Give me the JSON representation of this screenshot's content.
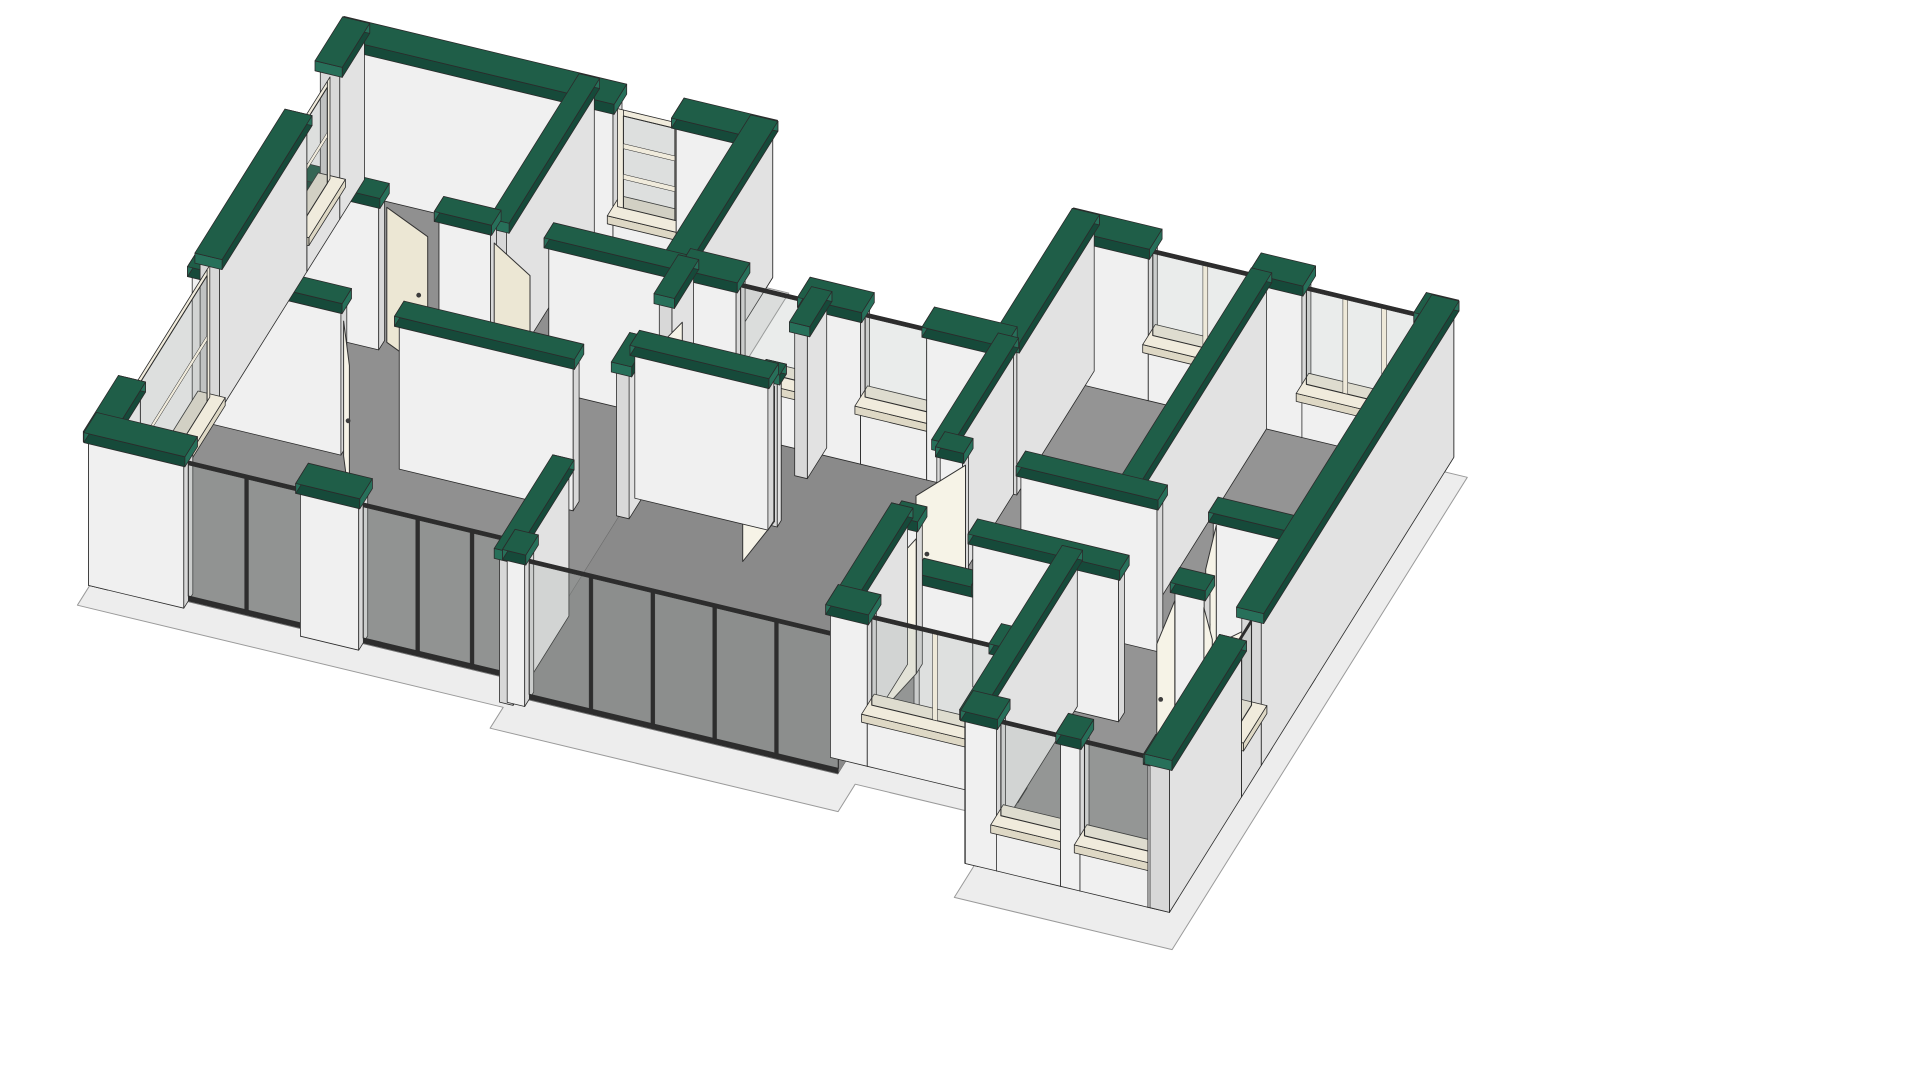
{
  "meta": {
    "view_label": "3D cutaway axonometric floor plan",
    "background": "#ffffff"
  },
  "colors": {
    "line": "#2b2b2b",
    "capTop": "#1f5e48",
    "capSkirt": "#164a3a",
    "capEnd": "#27705a",
    "wallFaceU": "#f0f0f0",
    "wallFaceV": "#e2e2e2",
    "wallEnd": "#d8d8d8",
    "floor1": "#909090",
    "floor2": "#8a8a8a",
    "floor3": "#949494",
    "floorStroke": "#6f6f6f",
    "slab": "#ededed",
    "slabStroke": "#9a9a9a",
    "door": "#f6f3e7",
    "doorShade": "#ece7d4",
    "handle": "#3c3c3c",
    "sill": "#f0ebdc",
    "sillShade": "#ded8c5",
    "glass": "rgba(150,158,155,0.20)",
    "glassDark": "rgba(120,128,125,0.25)",
    "frameDark": "#2d2d2d",
    "postCream": "#eee9d9",
    "halfTop": "#e9e9e9"
  },
  "scene": {
    "projection": {
      "origin": [
        345,
        175
      ],
      "u": [
        0.972,
        0.233
      ],
      "v": [
        -0.45,
        0.72
      ],
      "wallHeight": 148,
      "doorHeight": 135,
      "slabDrop": 20
    },
    "slab": {
      "name": "foundation-slab",
      "pts": [
        [
          -10,
          -10
        ],
        [
          452,
          -10
        ],
        [
          452,
          178
        ],
        [
          758,
          178
        ],
        [
          758,
          16
        ],
        [
          1162,
          16
        ],
        [
          1162,
          672
        ],
        [
          938,
          672
        ],
        [
          938,
          564
        ],
        [
          786,
          564
        ],
        [
          786,
          602
        ],
        [
          428,
          602
        ],
        [
          428,
          573
        ],
        [
          -10,
          573
        ]
      ]
    },
    "floors": [
      {
        "id": "left-wing-floor",
        "color": "floor1",
        "pts": [
          [
            14,
            14
          ],
          [
            436,
            14
          ],
          [
            436,
            561
          ],
          [
            14,
            561
          ]
        ]
      },
      {
        "id": "central-floor",
        "color": "floor2",
        "pts": [
          [
            436,
            196
          ],
          [
            776,
            196
          ],
          [
            776,
            581
          ],
          [
            436,
            581
          ]
        ]
      },
      {
        "id": "right-wing-floor",
        "color": "floor3",
        "pts": [
          [
            762,
            36
          ],
          [
            1146,
            36
          ],
          [
            1146,
            651
          ],
          [
            953,
            651
          ],
          [
            953,
            551
          ],
          [
            762,
            551
          ]
        ]
      }
    ],
    "walls": [
      {
        "id": "lw-n",
        "dir": "u",
        "c": 10,
        "t": 20,
        "from": 0,
        "to": 440,
        "cap": true,
        "open": [
          {
            "a": 285,
            "b": 350,
            "k": "winf",
            "sill": 34,
            "head": 140,
            "bars": 2
          }
        ]
      },
      {
        "id": "lw-w",
        "dir": "v",
        "c": 10,
        "t": 20,
        "from": 0,
        "to": 570,
        "cap": true,
        "open": [
          {
            "a": 55,
            "b": 128,
            "k": "winf",
            "sill": 30,
            "head": 140,
            "bars": 1
          },
          {
            "a": 322,
            "b": 498,
            "k": "winf",
            "sill": 4,
            "head": 144,
            "bars": 1
          }
        ]
      },
      {
        "id": "lw-s",
        "dir": "u",
        "c": 560,
        "t": 20,
        "from": 0,
        "to": 446,
        "cap": true,
        "open": [
          {
            "a": 98,
            "b": 218,
            "k": "glass"
          },
          {
            "a": 278,
            "b": 446,
            "k": "glass"
          }
        ]
      },
      {
        "id": "lw-e",
        "dir": "v",
        "c": 430,
        "t": 20,
        "from": 0,
        "to": 190,
        "cap": true,
        "open": []
      },
      {
        "id": "lw-i1",
        "dir": "u",
        "c": 195,
        "t": 13,
        "from": 0,
        "to": 440,
        "cap": true,
        "open": [
          {
            "a": 128,
            "b": 190,
            "k": "door"
          },
          {
            "a": 243,
            "b": 303,
            "k": "door"
          }
        ]
      },
      {
        "id": "lw-i2",
        "dir": "v",
        "c": 250,
        "t": 13,
        "from": 0,
        "to": 195,
        "cap": true,
        "open": []
      },
      {
        "id": "lw-i3",
        "dir": "u",
        "c": 333,
        "t": 13,
        "from": 0,
        "to": 392,
        "cap": true,
        "open": [
          {
            "a": 153,
            "b": 213,
            "k": "door"
          }
        ]
      },
      {
        "id": "lw-i4",
        "dir": "v",
        "c": 440,
        "t": 13,
        "from": 190,
        "to": 333,
        "cap": true,
        "open": [
          {
            "a": 238,
            "b": 298,
            "k": "door"
          }
        ]
      },
      {
        "id": "c-n",
        "dir": "u",
        "c": 190,
        "t": 20,
        "from": 440,
        "to": 770,
        "cap": true,
        "open": [
          {
            "a": 495,
            "b": 563,
            "k": "win",
            "sill": 52
          },
          {
            "a": 623,
            "b": 691,
            "k": "win",
            "sill": 52
          }
        ]
      },
      {
        "id": "c-room-s",
        "dir": "u",
        "c": 300,
        "t": 13,
        "from": 440,
        "to": 577,
        "cap": true,
        "open": []
      },
      {
        "id": "c-room-e",
        "dir": "v",
        "c": 577,
        "t": 13,
        "from": 190,
        "to": 300,
        "cap": true,
        "open": [
          {
            "a": 233,
            "b": 291,
            "k": "door"
          }
        ]
      },
      {
        "id": "c-s",
        "dir": "u",
        "c": 580,
        "t": 20,
        "from": 440,
        "to": 776,
        "cap": true,
        "open": [
          {
            "a": 458,
            "b": 776,
            "k": "glass"
          }
        ]
      },
      {
        "id": "c-w-stub",
        "dir": "v",
        "c": 440,
        "t": 14,
        "from": 468,
        "to": 592,
        "cap": true,
        "open": []
      },
      {
        "id": "rw-w-up",
        "dir": "v",
        "c": 770,
        "t": 20,
        "from": 20,
        "to": 192,
        "cap": true,
        "open": []
      },
      {
        "id": "rw-w-mid",
        "dir": "v",
        "c": 770,
        "t": 13,
        "from": 192,
        "to": 334,
        "cap": true,
        "open": []
      },
      {
        "id": "rw-w-low",
        "dir": "v",
        "c": 770,
        "t": 14,
        "from": 428,
        "to": 560,
        "cap": true,
        "open": []
      },
      {
        "id": "rw-n",
        "dir": "u",
        "c": 30,
        "t": 20,
        "from": 760,
        "to": 1150,
        "cap": true,
        "open": [
          {
            "a": 845,
            "b": 953,
            "k": "win",
            "sill": 50,
            "posts": 1
          },
          {
            "a": 1003,
            "b": 1123,
            "k": "win",
            "sill": 38,
            "posts": 2
          }
        ]
      },
      {
        "id": "rw-div",
        "dir": "v",
        "c": 960,
        "t": 13,
        "from": 40,
        "to": 334,
        "cap": true,
        "open": []
      },
      {
        "id": "rw-hall-n",
        "dir": "u",
        "c": 334,
        "t": 13,
        "from": 770,
        "to": 1150,
        "cap": true,
        "open": [
          {
            "a": 793,
            "b": 853,
            "k": "door"
          },
          {
            "a": 993,
            "b": 1051,
            "k": "door"
          }
        ]
      },
      {
        "id": "rw-hall-s",
        "dir": "u",
        "c": 430,
        "t": 13,
        "from": 770,
        "to": 1150,
        "cap": true,
        "open": [
          {
            "a": 790,
            "b": 848,
            "k": "door"
          },
          {
            "a": 998,
            "b": 1056,
            "k": "door"
          },
          {
            "a": 1086,
            "b": 1146,
            "k": "door"
          }
        ]
      },
      {
        "id": "rw-bath-s",
        "dir": "u",
        "c": 553,
        "t": 20,
        "from": 760,
        "to": 953,
        "cap": true,
        "open": [
          {
            "a": 798,
            "b": 928,
            "k": "win",
            "sill": 46,
            "posts": 1
          }
        ]
      },
      {
        "id": "rw-master-w",
        "dir": "v",
        "c": 946,
        "t": 13,
        "from": 430,
        "to": 652,
        "cap": true,
        "open": []
      },
      {
        "id": "rw-master-s",
        "dir": "u",
        "c": 642,
        "t": 20,
        "from": 940,
        "to": 1150,
        "cap": true,
        "open": [
          {
            "a": 972,
            "b": 1038,
            "k": "win",
            "sill": 40
          },
          {
            "a": 1058,
            "b": 1128,
            "k": "win",
            "sill": 40
          }
        ]
      },
      {
        "id": "rw-e",
        "dir": "v",
        "c": 1140,
        "t": 20,
        "from": 20,
        "to": 652,
        "cap": true,
        "open": [
          {
            "a": 448,
            "b": 492,
            "k": "win",
            "sill": 50
          }
        ]
      },
      {
        "id": "bath-wc-e",
        "dir": "v",
        "c": 887,
        "t": 13,
        "from": 430,
        "to": 498,
        "cap": true,
        "open": []
      },
      {
        "id": "bath-wc-s",
        "dir": "u",
        "c": 493,
        "t": 13,
        "from": 822,
        "to": 887,
        "cap": true,
        "open": []
      },
      {
        "id": "bath-half",
        "dir": "v",
        "c": 820,
        "t": 10,
        "from": 430,
        "to": 496,
        "cap": false,
        "h": 78,
        "open": []
      }
    ],
    "doors": [
      {
        "id": "door-bed1",
        "afterWall": "lw-i1",
        "hinge": [
          131,
          190
        ],
        "angle": 24,
        "len": 58
      },
      {
        "id": "door-mid",
        "afterWall": "lw-i1",
        "hinge": [
          247,
          202
        ],
        "angle": 30,
        "len": 58
      },
      {
        "id": "door-living",
        "afterWall": "lw-i3",
        "hinge": [
          156,
          340
        ],
        "angle": 60,
        "len": 60
      },
      {
        "id": "door-entry",
        "afterWall": "c-room-e",
        "hinge": [
          578,
          294
        ],
        "angle": 96,
        "len": 58
      },
      {
        "id": "door-link",
        "afterWall": "lw-i4",
        "hinge": [
          448,
          298
        ],
        "angle": -78,
        "len": 56
      },
      {
        "id": "door-bed2",
        "afterWall": "rw-hall-n",
        "hinge": [
          793,
          334
        ],
        "angle": 118,
        "len": 58
      },
      {
        "id": "door-bed3",
        "afterWall": "rw-hall-n",
        "hinge": [
          1051,
          334
        ],
        "angle": 75,
        "len": 58
      },
      {
        "id": "door-master",
        "afterWall": "rw-hall-s",
        "hinge": [
          1056,
          437
        ],
        "angle": 82,
        "len": 58
      },
      {
        "id": "door-closet-l",
        "afterWall": "rw-hall-s",
        "hinge": [
          1086,
          437
        ],
        "angle": 55,
        "len": 44
      },
      {
        "id": "door-closet-r",
        "afterWall": "rw-hall-s",
        "hinge": [
          1146,
          437
        ],
        "angle": 125,
        "len": 44
      },
      {
        "id": "door-bath",
        "afterWall": "rw-hall-s",
        "hinge": [
          790,
          437
        ],
        "angle": 100,
        "len": 58
      }
    ]
  }
}
